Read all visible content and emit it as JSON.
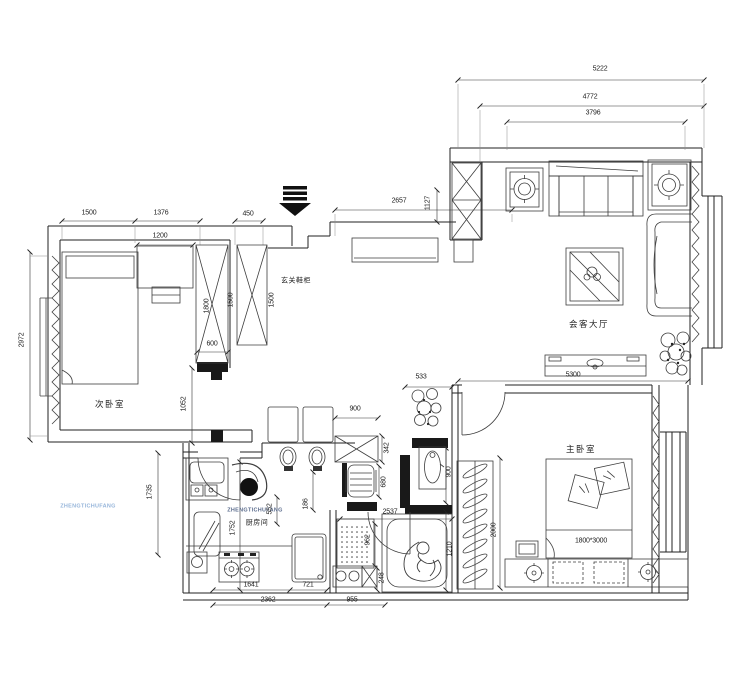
{
  "colors": {
    "paper": "#ffffff",
    "wall_ink": "#222222",
    "line_ink": "#3d3d3d",
    "dim_ink": "#1c1c1c",
    "wall_fill": "#191919",
    "watermark": "#5a6b8c",
    "watermark_light": "#96b5da"
  },
  "labels": {
    "second_bedroom": "次卧室",
    "entry_cabinet": "玄关鞋柜",
    "living_room": "会客大厅",
    "kitchen": "厨房间",
    "master_bedroom": "主卧室",
    "watermark": "ZHENGTICHUFANG",
    "watermark_left": "ZHENGTICHUFANG"
  },
  "dims": [
    {
      "v": "5222",
      "x": 600,
      "y": 69
    },
    {
      "v": "4772",
      "x": 590,
      "y": 97
    },
    {
      "v": "3796",
      "x": 593,
      "y": 113
    },
    {
      "v": "1500",
      "x": 89,
      "y": 213
    },
    {
      "v": "1376",
      "x": 161,
      "y": 213
    },
    {
      "v": "450",
      "x": 248,
      "y": 214
    },
    {
      "v": "1200",
      "x": 160,
      "y": 236
    },
    {
      "v": "2657",
      "x": 399,
      "y": 201
    },
    {
      "v": "1127",
      "x": 428,
      "y": 203,
      "rot": 1
    },
    {
      "v": "2972",
      "x": 22,
      "y": 340,
      "rot": 1
    },
    {
      "v": "1800",
      "x": 207,
      "y": 306,
      "rot": 1
    },
    {
      "v": "1500",
      "x": 231,
      "y": 300,
      "rot": 1
    },
    {
      "v": "1500",
      "x": 272,
      "y": 300,
      "rot": 1
    },
    {
      "v": "600",
      "x": 212,
      "y": 344
    },
    {
      "v": "1052",
      "x": 184,
      "y": 404,
      "rot": 1
    },
    {
      "v": "533",
      "x": 421,
      "y": 377
    },
    {
      "v": "5300",
      "x": 573,
      "y": 375
    },
    {
      "v": "900",
      "x": 355,
      "y": 409
    },
    {
      "v": "342",
      "x": 387,
      "y": 448,
      "rot": 1
    },
    {
      "v": "680",
      "x": 384,
      "y": 482,
      "rot": 1
    },
    {
      "v": "186",
      "x": 306,
      "y": 504,
      "rot": 1
    },
    {
      "v": "552",
      "x": 270,
      "y": 509,
      "rot": 1
    },
    {
      "v": "1752",
      "x": 233,
      "y": 528,
      "rot": 1
    },
    {
      "v": "1735",
      "x": 150,
      "y": 492,
      "rot": 1
    },
    {
      "v": "900",
      "x": 449,
      "y": 472,
      "rot": 1
    },
    {
      "v": "2537",
      "x": 390,
      "y": 512
    },
    {
      "v": "962",
      "x": 368,
      "y": 540,
      "rot": 1
    },
    {
      "v": "248",
      "x": 382,
      "y": 578,
      "rot": 1
    },
    {
      "v": "1210",
      "x": 450,
      "y": 549,
      "rot": 1
    },
    {
      "v": "2000",
      "x": 494,
      "y": 530,
      "rot": 1
    },
    {
      "v": "1641",
      "x": 251,
      "y": 585
    },
    {
      "v": "721",
      "x": 308,
      "y": 585
    },
    {
      "v": "2362",
      "x": 268,
      "y": 600
    },
    {
      "v": "955",
      "x": 352,
      "y": 600
    },
    {
      "v": "1800*3000",
      "x": 591,
      "y": 541
    }
  ]
}
